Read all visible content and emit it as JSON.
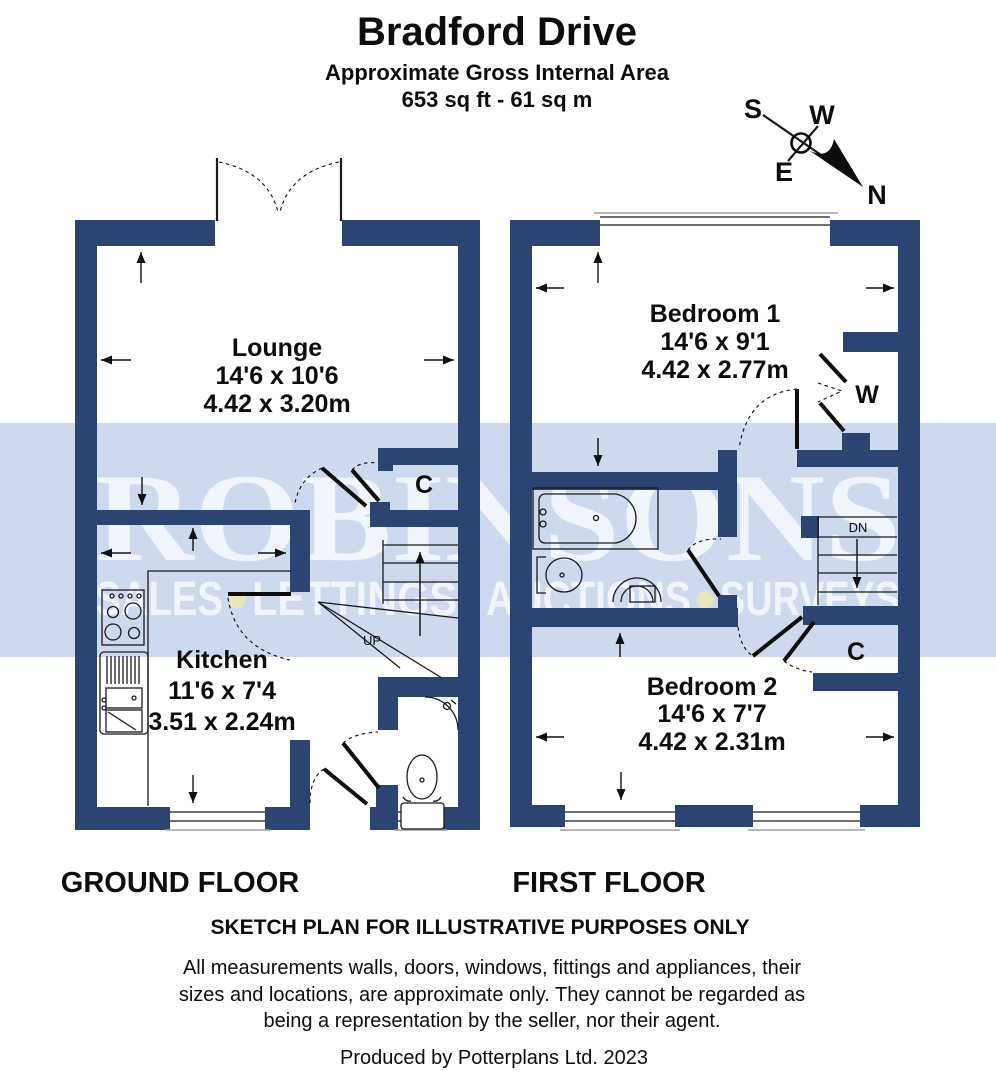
{
  "header": {
    "title": "Bradford Drive",
    "subtitle": "Approximate Gross Internal Area",
    "area": "653 sq ft - 61 sq m"
  },
  "compass": {
    "north": "N",
    "south": "S",
    "east": "E",
    "west": "W"
  },
  "watermark": {
    "name": "ROBINSONS",
    "tagline_words": [
      "SALES",
      "LETTINGS",
      "AUCTIONS",
      "SURVEYS"
    ],
    "bullet_separator": "•"
  },
  "ground_floor": {
    "label": "GROUND FLOOR",
    "lounge": {
      "name": "Lounge",
      "imperial": "14'6 x 10'6",
      "metric": "4.42 x 3.20m"
    },
    "kitchen": {
      "name": "Kitchen",
      "imperial": "11'6 x 7'4",
      "metric": "3.51 x 2.24m"
    },
    "cupboard_label": "C",
    "stairs_label": "UP"
  },
  "first_floor": {
    "label": "FIRST FLOOR",
    "bedroom1": {
      "name": "Bedroom 1",
      "imperial": "14'6 x 9'1",
      "metric": "4.42 x 2.77m"
    },
    "bedroom2": {
      "name": "Bedroom 2",
      "imperial": "14'6 x 7'7",
      "metric": "4.42 x 2.31m"
    },
    "wardrobe_label": "W",
    "stairs_label": "DN",
    "cupboard_label": "C"
  },
  "footer": {
    "note": "SKETCH PLAN FOR ILLUSTRATIVE PURPOSES ONLY",
    "disclaimer_lines": [
      "All measurements walls, doors, windows, fittings and appliances, their",
      "sizes and locations, are approximate only. They cannot be regarded as",
      "being a representation by the seller, nor their agent."
    ],
    "produced_by": "Produced by Potterplans Ltd. 2023"
  },
  "colors": {
    "wall_navy": "#2b4472",
    "watermark_band": "#cfd9ee",
    "watermark_text": "#f1f4fb",
    "bullet_yellow": "#eae6bb",
    "line_black": "#1a1a1a"
  }
}
